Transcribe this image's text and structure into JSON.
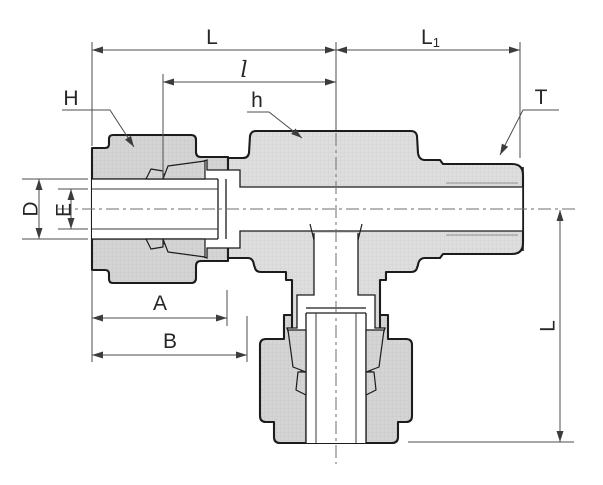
{
  "drawing": {
    "type": "technical_section_drawing",
    "subject": "Compression tube fitting male run tee - sectioned dimension drawing",
    "labels": {
      "L_top": "L",
      "L1_main": "L",
      "L1_sub": "1",
      "l_center": "l",
      "H_nut": "H",
      "h_body": "h",
      "T_thread": "T",
      "D_tube": "D",
      "E_bore": "E",
      "A_nut_length": "A",
      "B_length": "B",
      "L_vertical": "L"
    },
    "colors": {
      "background": "#ffffff",
      "outline": "#1c1c1c",
      "metal_fill": "#dedede",
      "metal_fill_dark": "#d5d5d5",
      "dimension": "#4d4d4d",
      "centerline": "#6e6e6e"
    }
  }
}
